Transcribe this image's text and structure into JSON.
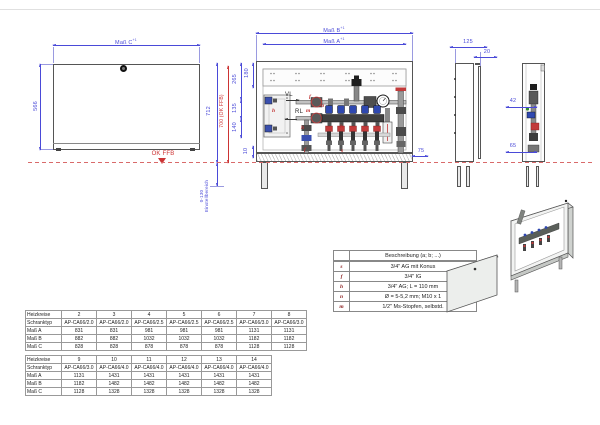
{
  "drawing": {
    "front": {
      "dim_c": "Maß C",
      "dim_c_tol": "+1",
      "height": "566",
      "ok_ffb": "OK FFB"
    },
    "main": {
      "dim_b": "Maß B",
      "dim_b_tol": "+1",
      "dim_a": "Maß A",
      "dim_a_tol": "+1",
      "v712": "712",
      "v700": "700 (OK FFB)",
      "v265": "265",
      "v180": "180",
      "v135": "135",
      "v140": "140",
      "v10": "10",
      "h75": "75",
      "range": "0-130",
      "range_label": "Einstellbereich",
      "vl": "VL",
      "rl": "RL"
    },
    "letters": {
      "f": "f",
      "n": "n",
      "m": "m",
      "h": "h",
      "s": "s"
    },
    "side": {
      "width": "125",
      "door": "20"
    },
    "section": {
      "d42": "42",
      "d65": "65"
    }
  },
  "legend": {
    "header": "Beschreibung (a; b; ...)",
    "rows": [
      [
        "s",
        "3/4\" AG mit Konus"
      ],
      [
        "f",
        "3/4\" IG"
      ],
      [
        "h",
        "3/4\" AG; L = 110 mm"
      ],
      [
        "n",
        "Ø = 5-5,2 mm; M10 x 1"
      ],
      [
        "m",
        "1/2\" Ms-Stopfen, selbstd."
      ]
    ]
  },
  "tables": {
    "t1": [
      [
        "Heizkreise",
        "2",
        "3",
        "4",
        "5",
        "6",
        "7",
        "8"
      ],
      [
        "Schranktyp",
        "AP-CA66/2.0",
        "AP-CA66/2.0",
        "AP-CA66/2.5",
        "AP-CA66/2.5",
        "AP-CA66/2.5",
        "AP-CA66/3.0",
        "AP-CA66/3.0"
      ],
      [
        "Maß A",
        "831",
        "831",
        "981",
        "981",
        "981",
        "1131",
        "1131"
      ],
      [
        "Maß B",
        "882",
        "882",
        "1032",
        "1032",
        "1032",
        "1182",
        "1182"
      ],
      [
        "Maß C",
        "828",
        "828",
        "878",
        "878",
        "878",
        "1128",
        "1128"
      ]
    ],
    "t2": [
      [
        "Heizkreise",
        "9",
        "10",
        "11",
        "12",
        "13",
        "14"
      ],
      [
        "Schranktyp",
        "AP-CA66/3.0",
        "AP-CA66/4.0",
        "AP-CA66/4.0",
        "AP-CA66/4.0",
        "AP-CA66/4.0",
        "AP-CA66/4.0"
      ],
      [
        "Maß A",
        "1131",
        "1431",
        "1431",
        "1431",
        "1431",
        "1431"
      ],
      [
        "Maß B",
        "1182",
        "1482",
        "1482",
        "1482",
        "1482",
        "1482"
      ],
      [
        "Maß C",
        "1128",
        "1328",
        "1328",
        "1328",
        "1328",
        "1328"
      ]
    ]
  }
}
